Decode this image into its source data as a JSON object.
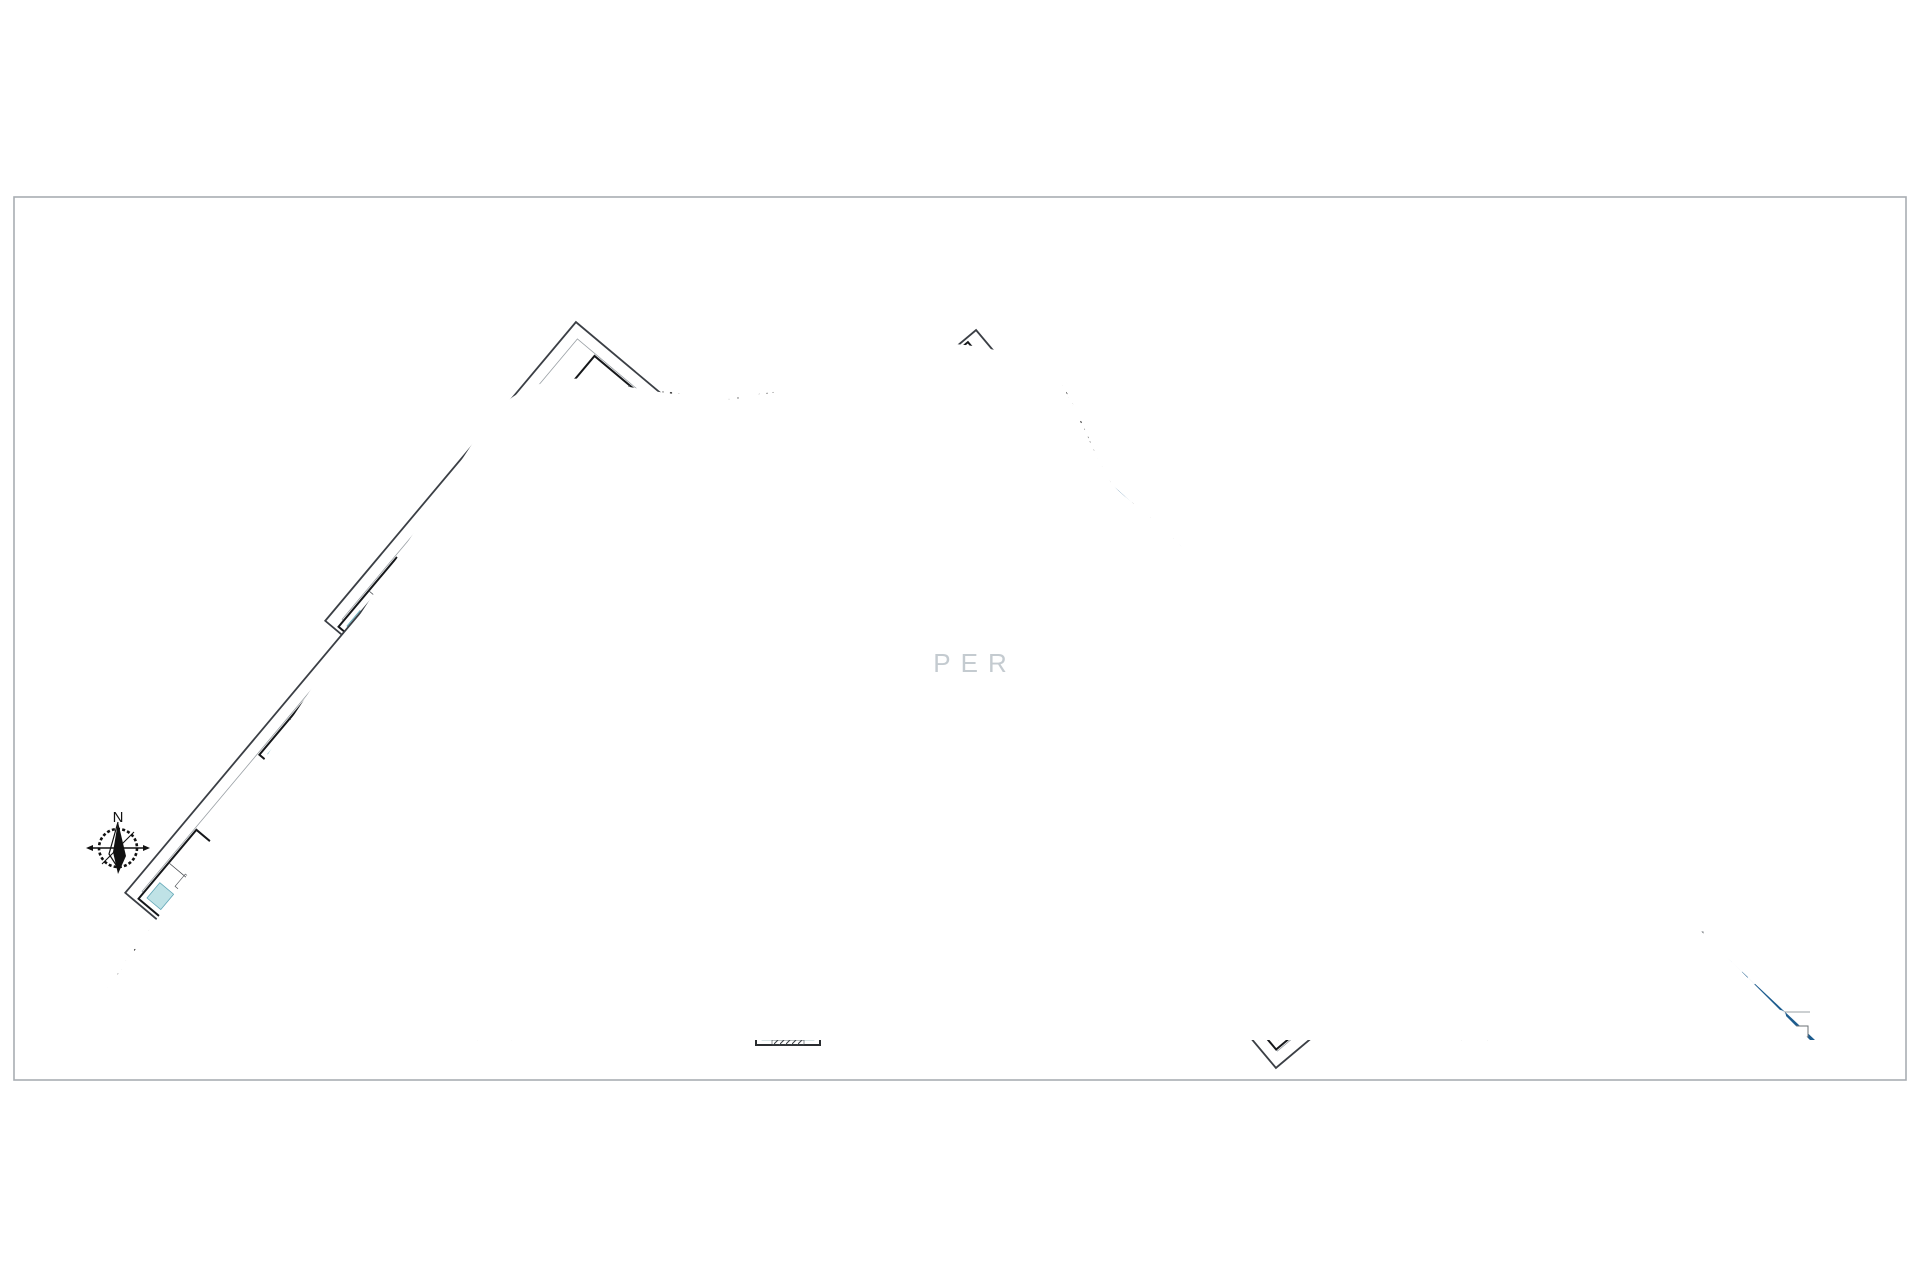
{
  "compass": {
    "label": "N"
  },
  "watermark": {
    "text": "PER"
  },
  "palette": {
    "dark_blue": "#1d5c8e",
    "deep_blue": "#10293c",
    "pool_teal": "#d7efee",
    "accent_teal": "#bfe2e6",
    "pool_edge": "#8fc3c3",
    "line_dark": "#15171a",
    "line_mid": "#44484d",
    "line_soft": "#8a8f94",
    "border_gray": "#a8adb2",
    "watermark_gray": "#8b98a3"
  },
  "buildings": [
    {
      "cx": 518,
      "cy": 528,
      "rot": -50
    },
    {
      "cx": 318,
      "cy": 800,
      "rot": -50
    },
    {
      "cx": 1034,
      "cy": 536,
      "rot": 50
    },
    {
      "cx": 1218,
      "cy": 862,
      "rot": 50
    }
  ],
  "lounger_chains": [
    {
      "x1": 702,
      "y1": 570,
      "x2": 876,
      "y2": 570,
      "n": 13
    },
    {
      "x1": 662,
      "y1": 712,
      "x2": 912,
      "y2": 712,
      "n": 17
    },
    {
      "x1": 668,
      "y1": 610,
      "x2": 562,
      "y2": 798,
      "n": 9
    },
    {
      "x1": 548,
      "y1": 822,
      "x2": 484,
      "y2": 928,
      "n": 6
    },
    {
      "x1": 908,
      "y1": 610,
      "x2": 1014,
      "y2": 798,
      "n": 9
    },
    {
      "x1": 1028,
      "y1": 822,
      "x2": 1092,
      "y2": 928,
      "n": 6
    },
    {
      "x1": 826,
      "y1": 878,
      "x2": 898,
      "y2": 916,
      "n": 6
    },
    {
      "x1": 720,
      "y1": 886,
      "x2": 746,
      "y2": 912,
      "n": 3
    },
    {
      "x1": 832,
      "y1": 977,
      "x2": 890,
      "y2": 977,
      "n": 5
    },
    {
      "x1": 702,
      "y1": 966,
      "x2": 738,
      "y2": 966,
      "n": 4
    },
    {
      "x1": 462,
      "y1": 942,
      "x2": 560,
      "y2": 996,
      "n": 8
    },
    {
      "x1": 1096,
      "y1": 942,
      "x2": 1196,
      "y2": 998,
      "n": 8
    },
    {
      "x1": 560,
      "y1": 520,
      "x2": 610,
      "y2": 560,
      "n": 4
    },
    {
      "x1": 966,
      "y1": 520,
      "x2": 1016,
      "y2": 560,
      "n": 4
    }
  ],
  "trees_on_blue": [
    {
      "x": 470,
      "y": 468,
      "r": 7
    },
    {
      "x": 455,
      "y": 494,
      "r": 5
    },
    {
      "x": 431,
      "y": 530,
      "r": 8
    },
    {
      "x": 402,
      "y": 573,
      "r": 6
    },
    {
      "x": 394,
      "y": 586,
      "r": 5
    },
    {
      "x": 372,
      "y": 622,
      "r": 7
    },
    {
      "x": 348,
      "y": 664,
      "r": 6
    },
    {
      "x": 340,
      "y": 676,
      "r": 5
    },
    {
      "x": 318,
      "y": 710,
      "r": 7
    },
    {
      "x": 292,
      "y": 754,
      "r": 6
    },
    {
      "x": 284,
      "y": 766,
      "r": 5
    },
    {
      "x": 264,
      "y": 798,
      "r": 6
    },
    {
      "x": 714,
      "y": 547,
      "r": 5
    },
    {
      "x": 748,
      "y": 551,
      "r": 4
    },
    {
      "x": 876,
      "y": 549,
      "r": 5
    },
    {
      "x": 910,
      "y": 545,
      "r": 4
    },
    {
      "x": 680,
      "y": 600,
      "r": 5
    },
    {
      "x": 896,
      "y": 600,
      "r": 5
    },
    {
      "x": 630,
      "y": 600,
      "r": 5
    },
    {
      "x": 592,
      "y": 672,
      "r": 6
    },
    {
      "x": 554,
      "y": 744,
      "r": 5
    },
    {
      "x": 518,
      "y": 816,
      "r": 6
    },
    {
      "x": 492,
      "y": 872,
      "r": 5
    },
    {
      "x": 946,
      "y": 600,
      "r": 5
    },
    {
      "x": 984,
      "y": 672,
      "r": 6
    },
    {
      "x": 1022,
      "y": 744,
      "r": 5
    },
    {
      "x": 1058,
      "y": 816,
      "r": 6
    },
    {
      "x": 1084,
      "y": 872,
      "r": 5
    },
    {
      "x": 1126,
      "y": 514,
      "r": 6
    },
    {
      "x": 1140,
      "y": 524,
      "r": 4
    },
    {
      "x": 1170,
      "y": 556,
      "r": 5
    },
    {
      "x": 1208,
      "y": 596,
      "r": 6
    },
    {
      "x": 1222,
      "y": 606,
      "r": 4
    },
    {
      "x": 1254,
      "y": 638,
      "r": 5
    },
    {
      "x": 1310,
      "y": 668,
      "r": 6
    },
    {
      "x": 1368,
      "y": 694,
      "r": 5
    },
    {
      "x": 1420,
      "y": 714,
      "r": 6
    },
    {
      "x": 1462,
      "y": 724,
      "r": 6
    },
    {
      "x": 1478,
      "y": 736,
      "r": 4
    },
    {
      "x": 1530,
      "y": 760,
      "r": 7
    },
    {
      "x": 1548,
      "y": 772,
      "r": 5
    },
    {
      "x": 1610,
      "y": 830,
      "r": 6
    },
    {
      "x": 1650,
      "y": 872,
      "r": 7
    },
    {
      "x": 1668,
      "y": 884,
      "r": 5
    },
    {
      "x": 1706,
      "y": 930,
      "r": 6
    },
    {
      "x": 1736,
      "y": 968,
      "r": 7
    },
    {
      "x": 1752,
      "y": 980,
      "r": 5
    },
    {
      "x": 1700,
      "y": 1004,
      "r": 5
    },
    {
      "x": 1780,
      "y": 1016,
      "r": 6
    },
    {
      "x": 1470,
      "y": 828,
      "r": 8
    },
    {
      "x": 1488,
      "y": 839,
      "r": 5
    },
    {
      "x": 322,
      "y": 1025,
      "r": 4
    },
    {
      "x": 366,
      "y": 1024,
      "r": 5
    },
    {
      "x": 424,
      "y": 1027,
      "r": 4
    },
    {
      "x": 504,
      "y": 1024,
      "r": 5
    },
    {
      "x": 548,
      "y": 1026,
      "r": 4
    },
    {
      "x": 604,
      "y": 1027,
      "r": 5
    },
    {
      "x": 668,
      "y": 1024,
      "r": 4
    },
    {
      "x": 714,
      "y": 1026,
      "r": 4
    },
    {
      "x": 850,
      "y": 1026,
      "r": 5
    },
    {
      "x": 898,
      "y": 1027,
      "r": 4
    },
    {
      "x": 948,
      "y": 1024,
      "r": 5
    },
    {
      "x": 1006,
      "y": 1026,
      "r": 4
    },
    {
      "x": 1068,
      "y": 1027,
      "r": 4
    },
    {
      "x": 1128,
      "y": 1024,
      "r": 5
    },
    {
      "x": 1192,
      "y": 1026,
      "r": 4
    },
    {
      "x": 1252,
      "y": 1027,
      "r": 5
    },
    {
      "x": 1308,
      "y": 1024,
      "r": 4
    },
    {
      "x": 1344,
      "y": 1026,
      "r": 4
    }
  ],
  "trees_on_stipple": [
    {
      "x": 706,
      "y": 424,
      "r": 8
    },
    {
      "x": 722,
      "y": 432,
      "r": 6
    },
    {
      "x": 737,
      "y": 420,
      "r": 5
    },
    {
      "x": 898,
      "y": 372,
      "r": 12
    },
    {
      "x": 921,
      "y": 386,
      "r": 8
    },
    {
      "x": 560,
      "y": 434,
      "r": 7
    },
    {
      "x": 577,
      "y": 444,
      "r": 5
    }
  ],
  "pale_tree_clusters": [
    {
      "x": 600,
      "y": 528
    },
    {
      "x": 483,
      "y": 706
    },
    {
      "x": 798,
      "y": 590
    },
    {
      "x": 950,
      "y": 873
    },
    {
      "x": 150,
      "y": 993
    },
    {
      "x": 725,
      "y": 995
    },
    {
      "x": 1105,
      "y": 690
    }
  ],
  "parking": {
    "rows": [
      {
        "x": 1480,
        "y": 860,
        "w": 124,
        "slots": 6
      },
      {
        "x": 1499,
        "y": 884,
        "w": 125,
        "slots": 6
      },
      {
        "x": 1518,
        "y": 908,
        "w": 146,
        "slots": 7
      },
      {
        "x": 1537,
        "y": 932,
        "w": 166,
        "slots": 8
      },
      {
        "x": 1556,
        "y": 957,
        "w": 167,
        "slots": 8
      },
      {
        "x": 1576,
        "y": 981,
        "w": 166,
        "slots": 8
      },
      {
        "x": 1594,
        "y": 1006,
        "w": 168,
        "slots": 8
      },
      {
        "x": 1716,
        "y": 1026,
        "w": 92,
        "slots": 3
      },
      {
        "x": 182,
        "y": 1028,
        "w": 96,
        "slots": 4
      }
    ]
  },
  "gate_furniture": [
    {
      "x": 770,
      "y": 952,
      "w": 14,
      "h": 10,
      "a": -10
    },
    {
      "x": 786,
      "y": 948,
      "w": 12,
      "h": 9,
      "a": 5
    },
    {
      "x": 800,
      "y": 956,
      "w": 13,
      "h": 9,
      "a": 12
    },
    {
      "x": 768,
      "y": 968,
      "w": 12,
      "h": 9,
      "a": 0
    },
    {
      "x": 784,
      "y": 966,
      "w": 14,
      "h": 10,
      "a": -6
    },
    {
      "x": 800,
      "y": 972,
      "w": 11,
      "h": 8,
      "a": 8
    },
    {
      "x": 776,
      "y": 984,
      "w": 13,
      "h": 9,
      "a": -4
    },
    {
      "x": 792,
      "y": 986,
      "w": 12,
      "h": 8,
      "a": 6
    }
  ]
}
